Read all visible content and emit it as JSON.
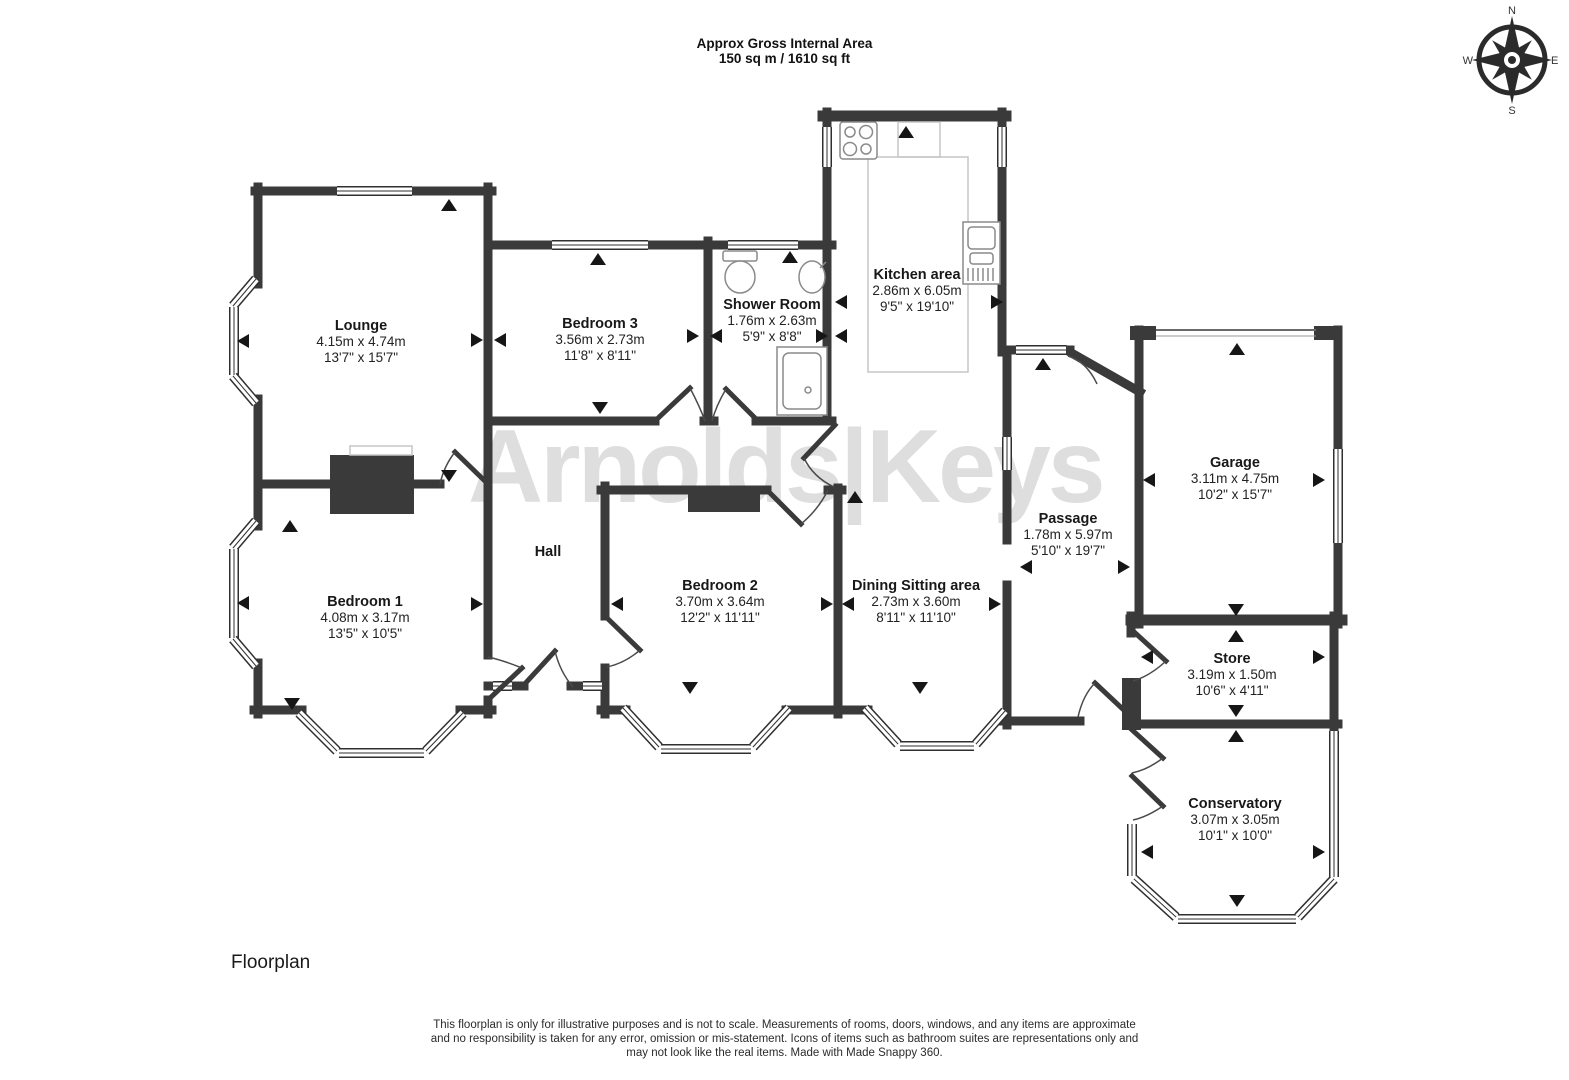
{
  "header": {
    "line1": "Approx Gross Internal Area",
    "line2": "150 sq m / 1610 sq ft"
  },
  "watermark": "Arnolds|Keys",
  "compass": {
    "n": "N",
    "e": "E",
    "s": "S",
    "w": "W"
  },
  "rooms": [
    {
      "name": "Lounge",
      "metric": "4.15m x 4.74m",
      "imperial": "13'7\" x 15'7\""
    },
    {
      "name": "Bedroom 3",
      "metric": "3.56m x 2.73m",
      "imperial": "11'8\" x 8'11\""
    },
    {
      "name": "Shower Room",
      "metric": "1.76m x 2.63m",
      "imperial": "5'9\" x 8'8\""
    },
    {
      "name": "Kitchen area",
      "metric": "2.86m x 6.05m",
      "imperial": "9'5\" x 19'10\""
    },
    {
      "name": "Hall",
      "metric": "",
      "imperial": ""
    },
    {
      "name": "Bedroom 1",
      "metric": "4.08m x 3.17m",
      "imperial": "13'5\" x 10'5\""
    },
    {
      "name": "Bedroom 2",
      "metric": "3.70m x 3.64m",
      "imperial": "12'2\" x 11'11\""
    },
    {
      "name": "Dining Sitting area",
      "metric": "2.73m x 3.60m",
      "imperial": "8'11\" x 11'10\""
    },
    {
      "name": "Passage",
      "metric": "1.78m x 5.97m",
      "imperial": "5'10\" x 19'7\""
    },
    {
      "name": "Garage",
      "metric": "3.11m x 4.75m",
      "imperial": "10'2\" x 15'7\""
    },
    {
      "name": "Store",
      "metric": "3.19m x 1.50m",
      "imperial": "10'6\" x 4'11\""
    },
    {
      "name": "Conservatory",
      "metric": "3.07m x 3.05m",
      "imperial": "10'1\" x 10'0\""
    }
  ],
  "footer": {
    "label": "Floorplan",
    "disclaimer": "This floorplan is only for illustrative purposes and is not to scale. Measurements of rooms, doors, windows, and any items are approximate and no responsibility is taken for any error, omission or mis-statement. Icons of items such as bathroom suites are representations only and may not look like the real items. Made with Made Snappy 360."
  }
}
